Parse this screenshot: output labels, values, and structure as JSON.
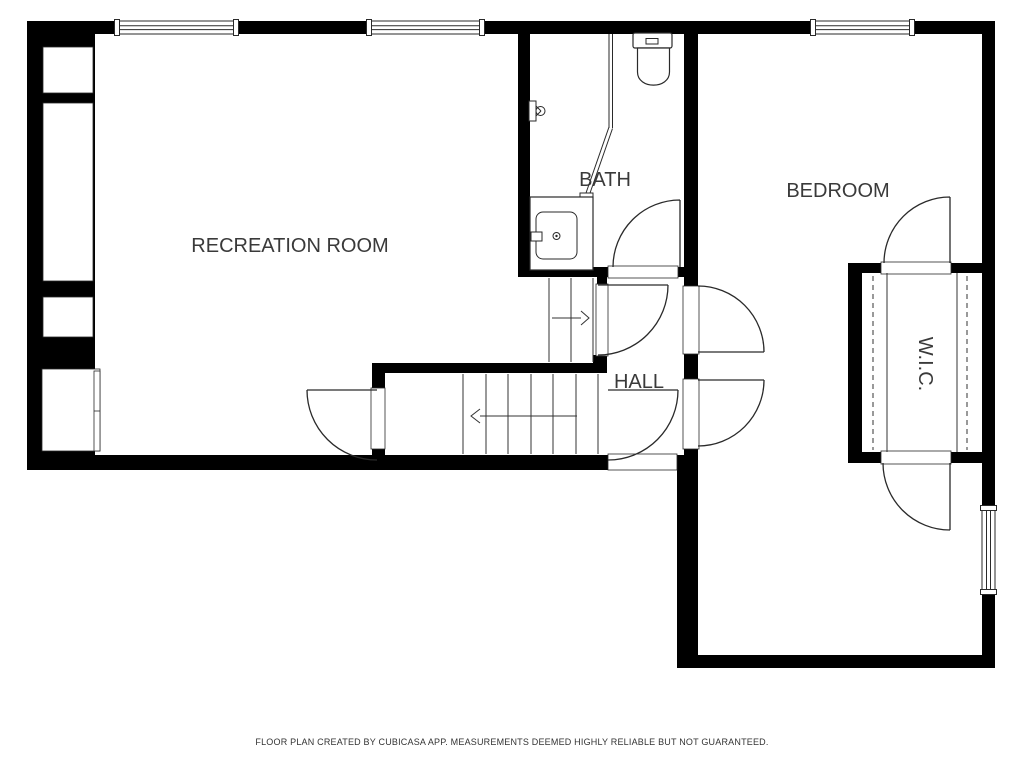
{
  "rooms": {
    "recreation": {
      "label": "RECREATION ROOM"
    },
    "bath": {
      "label": "BATH"
    },
    "bedroom": {
      "label": "BEDROOM"
    },
    "hall": {
      "label": "HALL"
    },
    "wic": {
      "label": "W.I.C."
    }
  },
  "footer": {
    "disclaimer": "FLOOR PLAN CREATED BY CUBICASA APP. MEASUREMENTS DEEMED HIGHLY RELIABLE BUT NOT GUARANTEED."
  },
  "fixtures": [
    "toilet",
    "sink-vanity",
    "shower-glass",
    "shower-head",
    "stairs-up-arrow",
    "stairs-down-arrow",
    "closet-rods",
    "door-swings",
    "windows"
  ],
  "colors": {
    "wall": "#000000",
    "line": "#2a2a2a",
    "label_text": "#3a3a3a",
    "background": "#ffffff"
  }
}
